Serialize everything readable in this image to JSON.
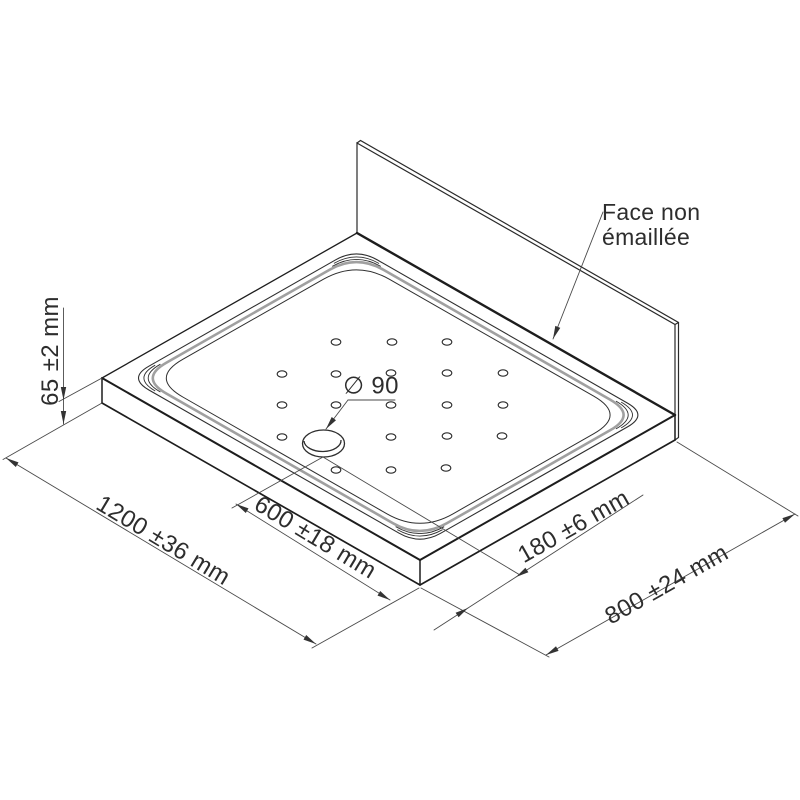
{
  "annotations": {
    "face_note_line1": "Face non",
    "face_note_line2": "émaillée",
    "drain_diameter": "∅ 90",
    "height": "65 ±2 mm",
    "length": "1200 ±36 mm",
    "drain_offset_length": "600 ±18 mm",
    "drain_offset_width": "180 ±6 mm",
    "width": "800 ±24 mm"
  },
  "colors": {
    "line": "#2a2a2a",
    "rim_band": "#a0a0a0",
    "dimension": "#4a4a4a",
    "background": "#ffffff"
  }
}
